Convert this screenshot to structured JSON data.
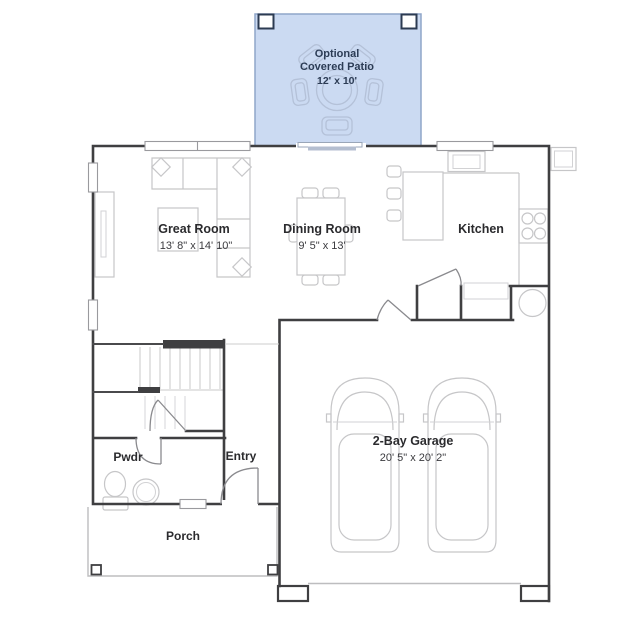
{
  "plan": {
    "type": "floor-plan",
    "palette": {
      "wall": "#3f3f41",
      "furniture_line": "#c6c6c8",
      "patio_fill": "#cbdaf2",
      "patio_stroke": "#8fa6c9",
      "patio_text": "#2c3c55",
      "label_text": "#2b2b2e",
      "background": "#ffffff"
    },
    "rooms": {
      "patio": {
        "line1": "Optional",
        "line2": "Covered Patio",
        "dims": "12' x 10'"
      },
      "great_room": {
        "label": "Great Room",
        "dims": "13' 8\" x 14' 10\""
      },
      "dining_room": {
        "label": "Dining Room",
        "dims": "9' 5\" x 13'"
      },
      "kitchen": {
        "label": "Kitchen"
      },
      "garage": {
        "label": "2-Bay Garage",
        "dims": "20' 5\" x 20' 2\""
      },
      "powder": {
        "label": "Pwdr"
      },
      "entry": {
        "label": "Entry"
      },
      "porch": {
        "label": "Porch"
      }
    }
  }
}
